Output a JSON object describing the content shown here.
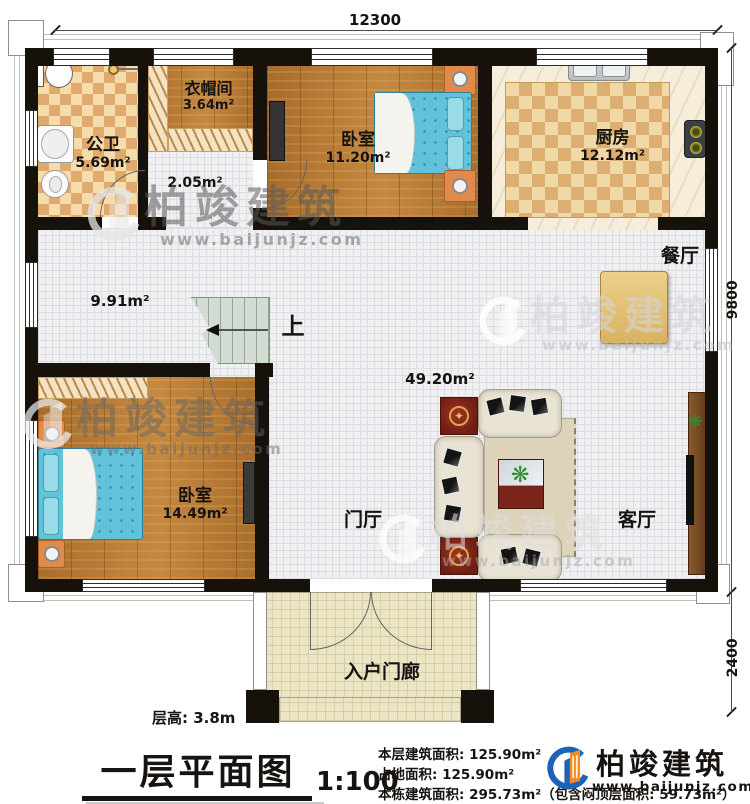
{
  "dimensions": {
    "width_top": "12300",
    "height_right_main": "9800",
    "height_right_porch": "2400"
  },
  "rooms": {
    "bathroom": {
      "name": "公卫",
      "area": "5.69m²"
    },
    "cloakroom": {
      "name": "衣帽间",
      "area": "3.64m²"
    },
    "hallway_small": {
      "area": "2.05m²"
    },
    "bedroom1": {
      "name": "卧室",
      "area": "11.20m²"
    },
    "kitchen": {
      "name": "厨房",
      "area": "12.12m²"
    },
    "dining": {
      "name": "餐厅"
    },
    "hallway_main": {
      "area": "9.91m²"
    },
    "great_room": {
      "area": "49.20m²"
    },
    "bedroom2": {
      "name": "卧室",
      "area": "14.49m²"
    },
    "foyer": {
      "name": "门厅"
    },
    "living": {
      "name": "客厅"
    },
    "porch": {
      "name": "入户门廊"
    }
  },
  "stairs": {
    "up_label": "上"
  },
  "footer": {
    "floor_height": "层高: 3.8m",
    "title": "一层平面图",
    "scale": "1:100",
    "area_line1": "本层建筑面积: 125.90m²",
    "area_line2": "占地面积: 125.90m²",
    "area_line3": "本栋建筑面积: 295.73m²（包含闷顶层面积: 59.73m²）"
  },
  "brand": {
    "name": "柏竣建筑",
    "url": "www.baijunjz.com",
    "blue": "#1c63b7",
    "orange": "#f28a1e"
  }
}
